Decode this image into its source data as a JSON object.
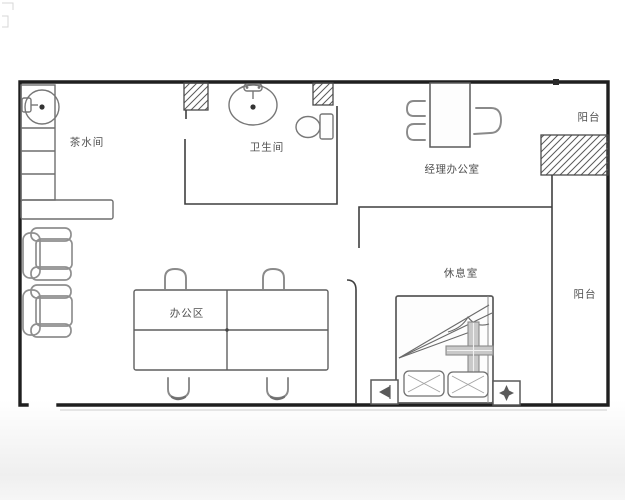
{
  "title": "office-floor-plan",
  "rooms": [
    {
      "id": "tea-room",
      "label": "茶水间"
    },
    {
      "id": "bathroom",
      "label": "卫生间"
    },
    {
      "id": "manager-office",
      "label": "经理办公室"
    },
    {
      "id": "balcony-top",
      "label": "阳台"
    },
    {
      "id": "lounge",
      "label": "休息室"
    },
    {
      "id": "balcony-right",
      "label": "阳台"
    },
    {
      "id": "office-area",
      "label": "办公区"
    }
  ],
  "fixtures": [
    "sink-icon",
    "counter",
    "wash-basin-icon",
    "toilet-icon",
    "manager-desk",
    "manager-chairs",
    "office-table",
    "office-chairs",
    "armchair",
    "bed",
    "pillows",
    "blanket",
    "nightstand-arrow-icon",
    "nightstand-star-icon",
    "wall-hatch-block",
    "entrance-gap"
  ],
  "colors": {
    "outer_wall": "#1f1f1f",
    "inner_wall": "#3f3f3f",
    "furniture": "#8a8a8a",
    "fixture_outline": "#5a5a5a",
    "label_text": "#4f4f4f",
    "background": "#ffffff"
  }
}
